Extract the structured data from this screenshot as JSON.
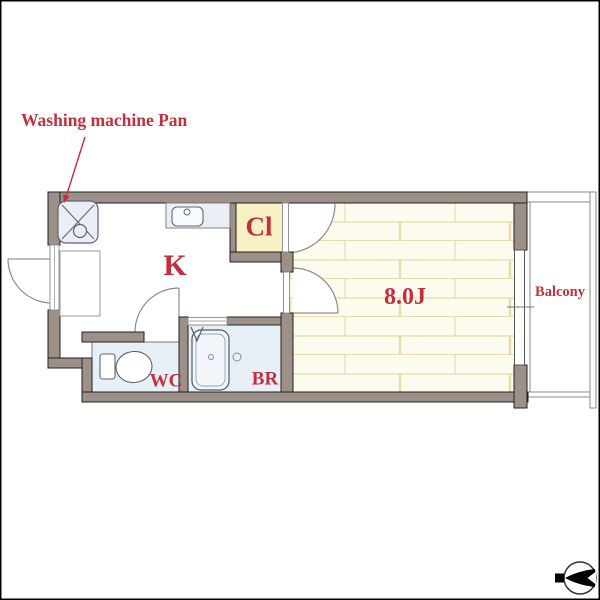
{
  "plan": {
    "annotation_label": "Washing machine Pan",
    "rooms": {
      "kitchen": "K",
      "closet": "Cl",
      "main_room": "8.0J",
      "toilet": "WC",
      "bath": "BR",
      "balcony": "Balcony"
    },
    "icons": {
      "compass": "compass-north-arrow-icon"
    },
    "colors": {
      "label_red": "#c52e3c",
      "wall_fill": "#9c9089",
      "closet_fill": "#f7f1c4",
      "wet_room_fill": "#e8f0f7",
      "tatami_fill": "#fdfaee",
      "tatami_line": "#e8dcab",
      "fixture_fill": "#e9eff5"
    }
  }
}
